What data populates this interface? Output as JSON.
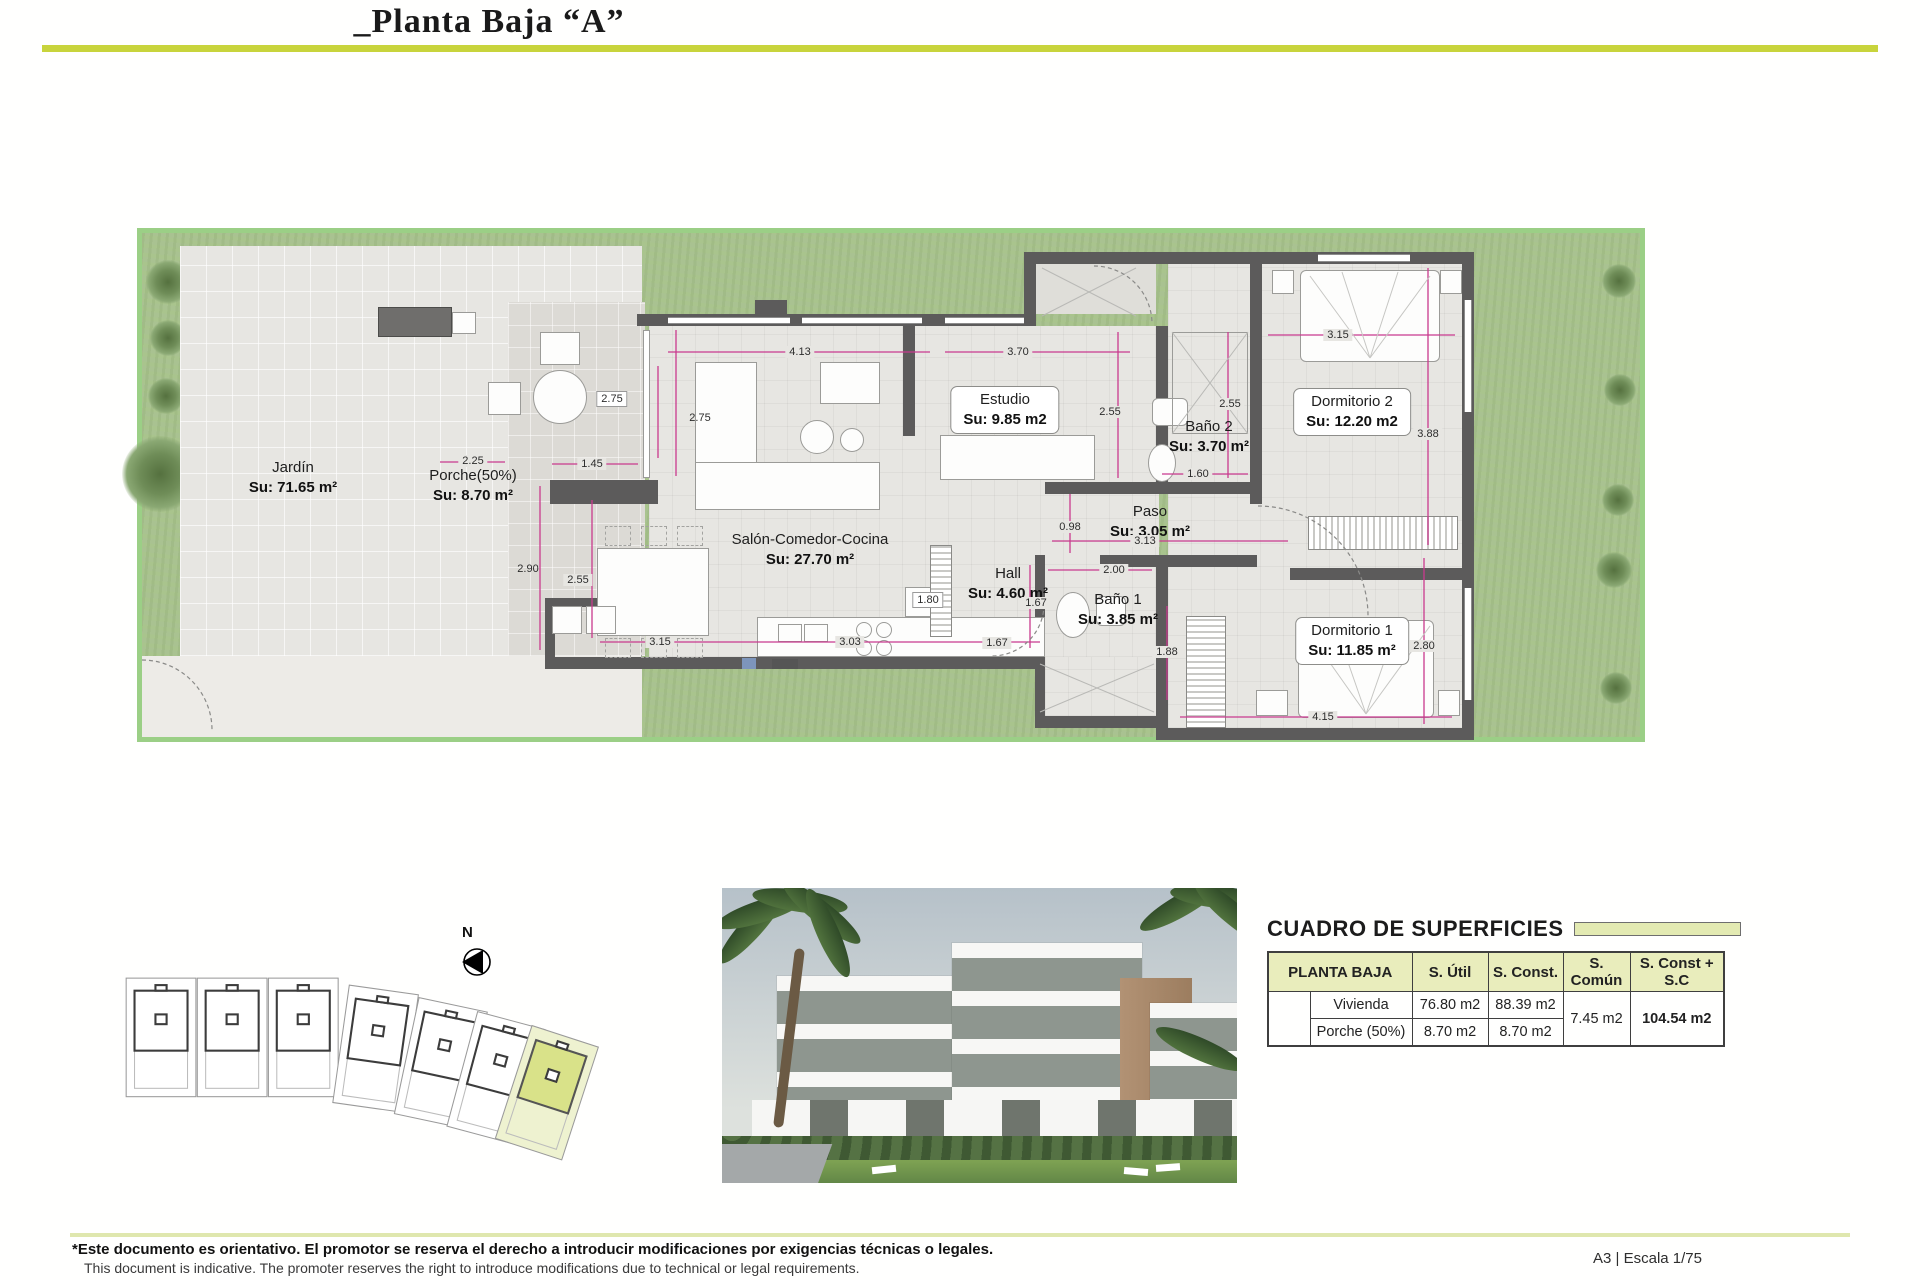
{
  "title": "_Planta Baja “A”",
  "plan": {
    "north": "N",
    "rooms": [
      {
        "name": "Jardín",
        "su": "Su: 71.65 m²"
      },
      {
        "name": "Porche(50%)",
        "su": "Su: 8.70 m²"
      },
      {
        "name": "Salón-Comedor-Cocina",
        "su": "Su: 27.70 m²"
      },
      {
        "name": "Estudio",
        "su": "Su: 9.85 m2"
      },
      {
        "name": "Baño 2",
        "su": "Su: 3.70 m²"
      },
      {
        "name": "Dormitorio 2",
        "su": "Su: 12.20 m2"
      },
      {
        "name": "Paso",
        "su": "Su: 3.05 m²"
      },
      {
        "name": "Hall",
        "su": "Su: 4.60 m²"
      },
      {
        "name": "Baño 1",
        "su": "Su: 3.85 m²"
      },
      {
        "name": "Dormitorio 1",
        "su": "Su: 11.85 m²"
      }
    ],
    "dims": [
      "4.13",
      "3.70",
      "2.75",
      "2.75",
      "1.45",
      "2.25",
      "2.90",
      "2.55",
      "3.15",
      "3.03",
      "1.80",
      "1.67",
      "1.67",
      "0.98",
      "3.13",
      "2.00",
      "1.88",
      "2.55",
      "2.55",
      "1.60",
      "3.15",
      "3.88",
      "2.80",
      "4.15"
    ]
  },
  "table": {
    "title": "CUADRO DE SUPERFICIES",
    "col_planta": "PLANTA BAJA",
    "col_util": "S. Útil",
    "col_const": "S. Const.",
    "col_comun": "S. Común",
    "col_total": "S. Const + S.C",
    "row1_label": "Vivienda",
    "row1_util": "76.80 m2",
    "row1_const": "88.39 m2",
    "row2_label": "Porche (50%)",
    "row2_util": "8.70 m2",
    "row2_const": "8.70 m2",
    "comun": "7.45 m2",
    "total": "104.54 m2"
  },
  "footer": {
    "disclaimer_es": "*Este documento es orientativo. El promotor se reserva el derecho a introducir modificaciones por exigencias técnicas o legales.",
    "disclaimer_en": "This document is indicative. The promoter reserves the right to introduce modifications due to technical or legal requirements.",
    "scale": "A3 | Escala 1/75"
  },
  "colors": {
    "accent_green": "#c8d43c",
    "table_header_bg": "#e9edbc",
    "garden_green": "#a9c291",
    "wall_gray": "#5c5b5b",
    "dimension_magenta": "#c93a8e",
    "highlight_plot": "#d9e289"
  }
}
